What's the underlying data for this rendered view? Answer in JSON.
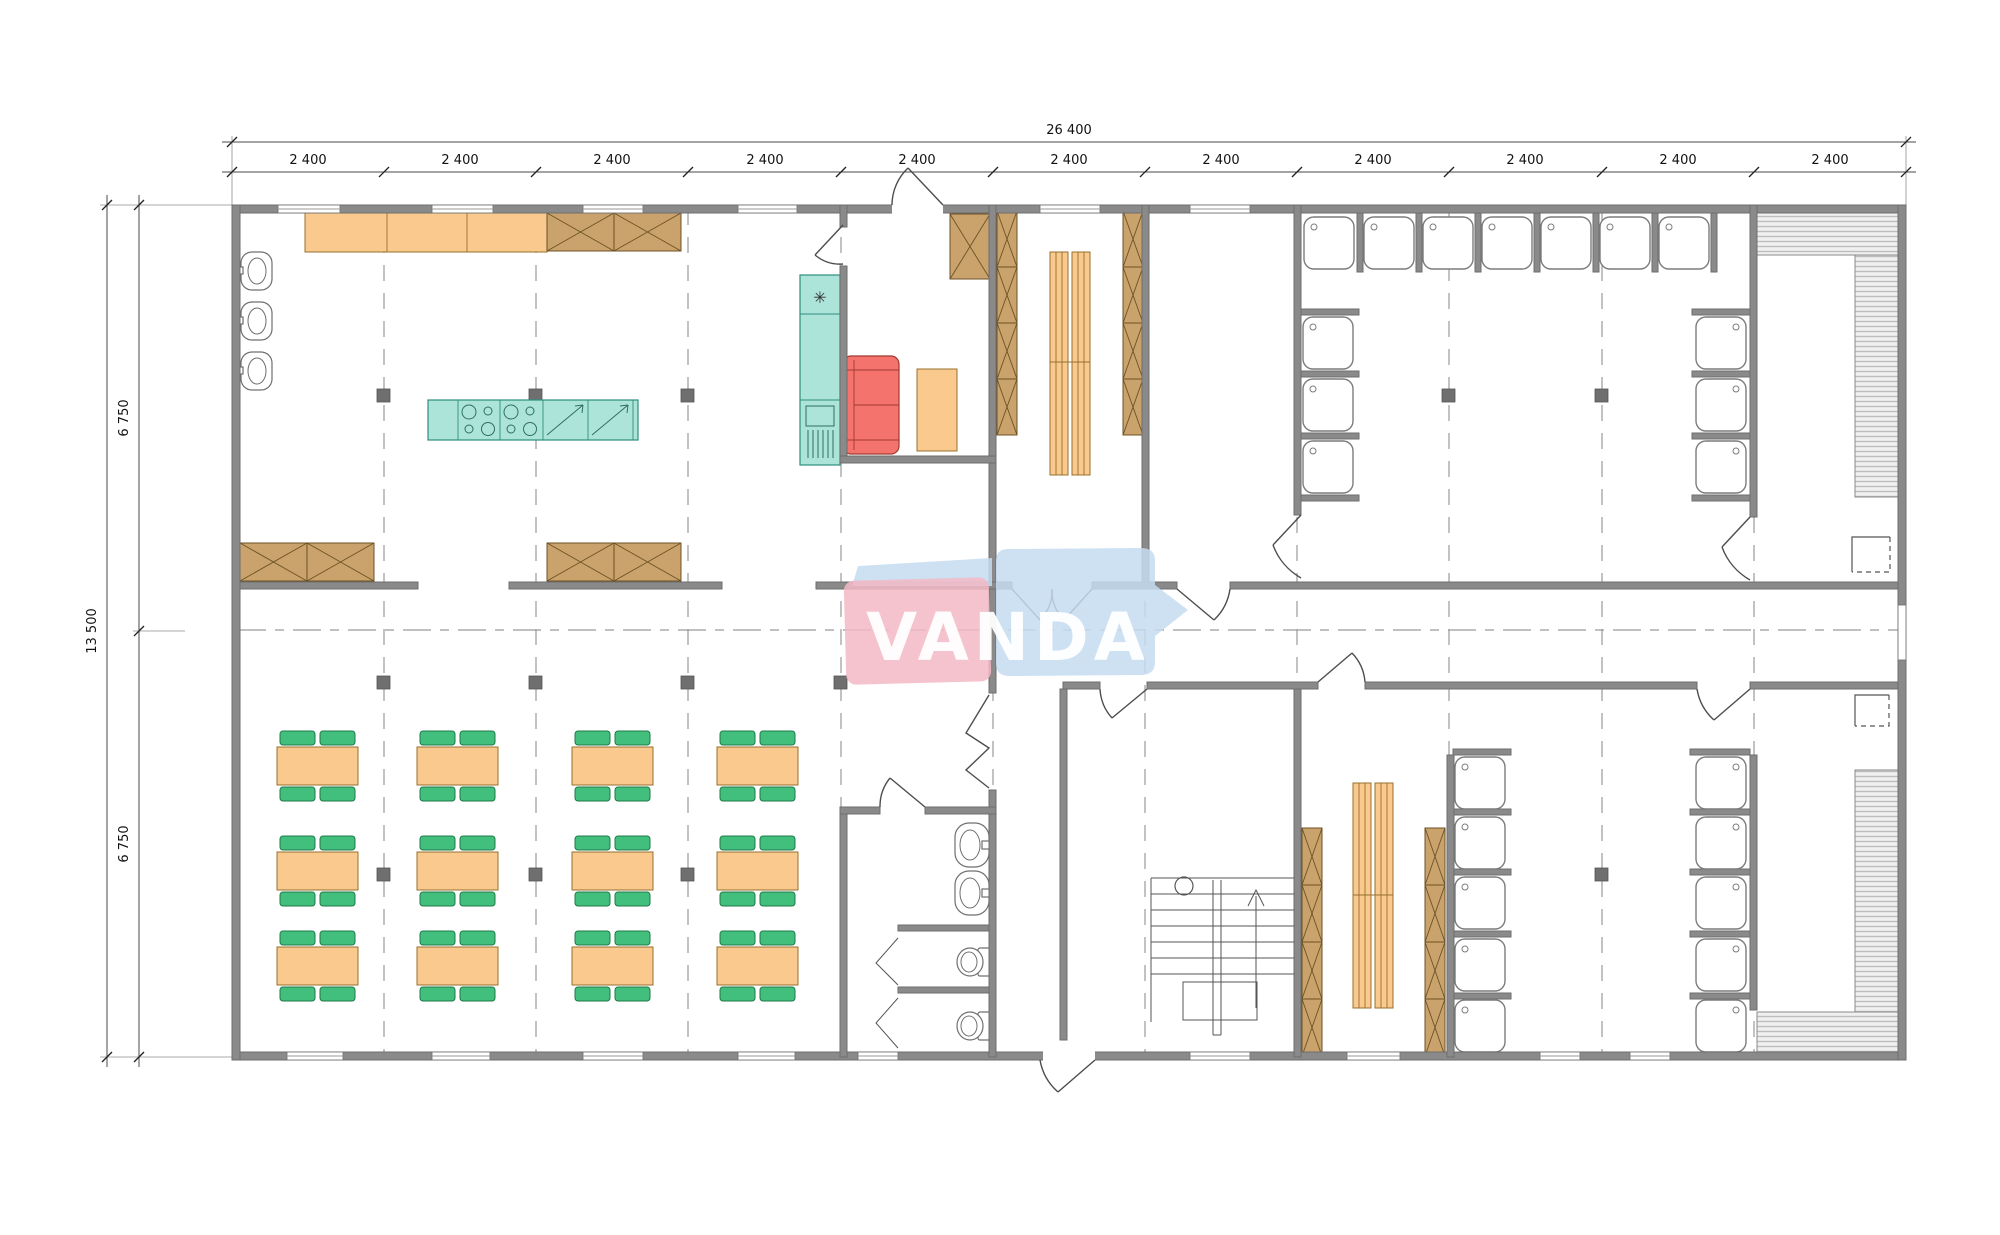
{
  "meta": {
    "drawing_type": "architectural floor plan, single storey modular building",
    "units": "mm"
  },
  "dims": {
    "total_width": "26 400",
    "modules": [
      "2 400",
      "2 400",
      "2 400",
      "2 400",
      "2 400",
      "2 400",
      "2 400",
      "2 400",
      "2 400",
      "2 400",
      "2 400"
    ],
    "total_height": "13 500",
    "height_halves": [
      "6 750",
      "6 750"
    ]
  },
  "watermark": {
    "text": "VANDA",
    "pink": "#F3B8C4",
    "blue": "#C5DCF1"
  },
  "palette": {
    "wall_gray": "#8A8A8A",
    "furniture_orange": "#FAC98D",
    "chair_green": "#43BF7D",
    "appliance_teal": "#ACE4D9",
    "sofa_red": "#F4736C",
    "cabinet_brown": "#C9A36B",
    "hatch_gray": "#C4C4C4"
  },
  "rooms": [
    {
      "name": "kitchen",
      "fixtures": [
        "wall-counter-3-sections",
        "storage-cabinets-2",
        "wash-basins-3",
        "cooking-island",
        "cooktops-2x4-burners",
        "dishwashers-2",
        "fridge-freezer-column",
        "pass-cabinets-4"
      ]
    },
    {
      "name": "staff-room",
      "fixtures": [
        "sofa",
        "table",
        "storage-cabinet",
        "exterior-door"
      ]
    },
    {
      "name": "storage-room",
      "fixtures": [
        "shelving-column-2",
        "double-rack",
        "double-door-to-corridor"
      ]
    },
    {
      "name": "dressing-room-top",
      "fixtures": [
        "door-to-corridor",
        "door-to-shower-room"
      ]
    },
    {
      "name": "shower-room-top",
      "fixtures": [
        "shower-stalls-13"
      ]
    },
    {
      "name": "sauna-top",
      "fixtures": [
        "l-shaped-bench",
        "sauna-heater"
      ]
    },
    {
      "name": "dining-hall",
      "fixtures": [
        "tables-12",
        "chairs-48"
      ]
    },
    {
      "name": "wc",
      "fixtures": [
        "wash-basins-2",
        "toilet-cubicles-2"
      ]
    },
    {
      "name": "entrance-corridor",
      "fixtures": [
        "main-entrance-door",
        "bifold-door"
      ]
    },
    {
      "name": "staircase-room",
      "fixtures": [
        "stairs-up",
        "handrail"
      ]
    },
    {
      "name": "changing-room-bottom",
      "fixtures": [
        "locker-columns-2",
        "double-bench"
      ]
    },
    {
      "name": "shower-room-bottom",
      "fixtures": [
        "shower-stalls-10"
      ]
    },
    {
      "name": "sauna-bottom",
      "fixtures": [
        "l-shaped-bench",
        "sauna-heater"
      ]
    }
  ]
}
